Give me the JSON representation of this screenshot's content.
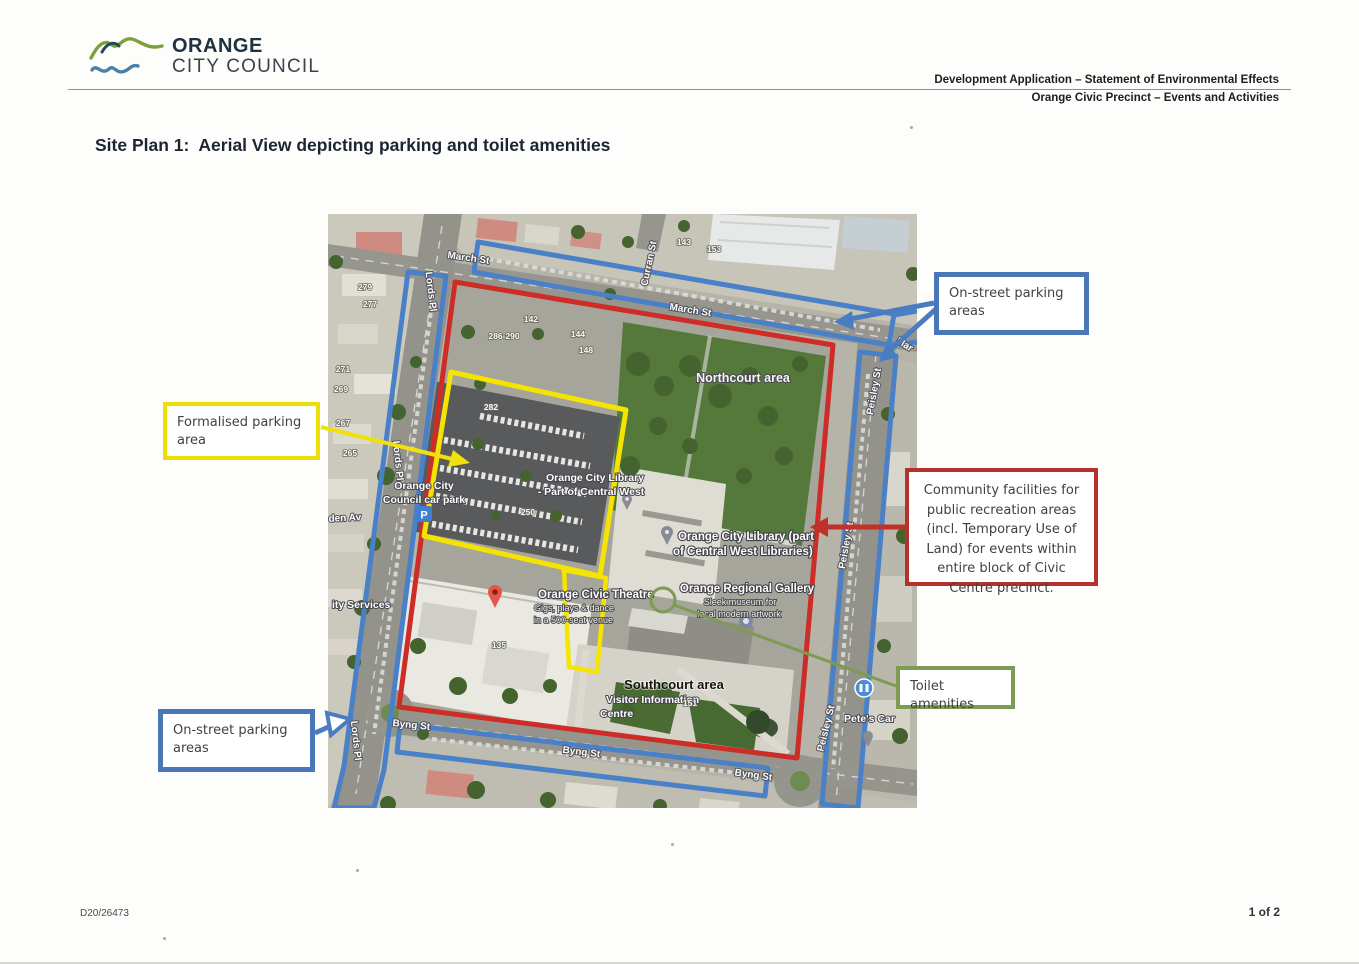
{
  "logo": {
    "name": "ORANGE",
    "subname": "CITY COUNCIL"
  },
  "header": {
    "line1": "Development Application – Statement of Environmental Effects",
    "line2": "Orange Civic Precinct – Events and Activities"
  },
  "title": "Site Plan 1:  Aerial View depicting parking and toilet amenities",
  "footer": {
    "ref": "D20/26473",
    "page": "1 of 2"
  },
  "colors": {
    "callout_blue": "#4a77b8",
    "callout_yellow": "#eddf05",
    "callout_red": "#b5312d",
    "callout_green": "#7d9b53",
    "overlay_blue": "#4a80c8",
    "overlay_red": "#cd2d26",
    "overlay_yellow": "#f4e400",
    "overlay_green": "#7d9b53"
  },
  "callouts": {
    "onstreet_top": {
      "text": "On-street parking areas"
    },
    "formalised": {
      "text": "Formalised parking area"
    },
    "community": {
      "text": "Community facilities for public recreation areas (incl. Temporary Use of Land) for events within entire block of Civic Centre precinct."
    },
    "toilet": {
      "text": "Toilet amenities"
    },
    "onstreet_bottom": {
      "text": "On-street parking areas"
    }
  },
  "map": {
    "streets": {
      "march1": "March St",
      "march2": "March St",
      "curran": "Curran St",
      "lords_top": "Lords Pl",
      "lords_mid": "Lords Pl",
      "lords_bottom": "Lords Pl",
      "peisley1": "Peisley St",
      "peisley2": "Peisley St",
      "peisley3": "Peisley St",
      "byng0": "Byng St",
      "byng1": "Byng St",
      "byng2": "Byng St",
      "avenue": "den Av",
      "mar": "Mar"
    },
    "places": {
      "northcourt": "Northcourt area",
      "southcourt": "Southcourt area",
      "council_l1": "Orange City",
      "council_l2": "Council car park",
      "libsmall_l1": "Orange City Library",
      "libsmall_l2": "- Part of Central West",
      "library_l1": "Orange City Library (part",
      "library_l2": "of Central West Libraries)",
      "gallery_l1": "Orange Regional Gallery",
      "gallery_l2": "Sleek museum for",
      "gallery_l3": "local modern artwork",
      "theatre_l1": "Orange Civic Theatre",
      "theatre_l2": "Gigs, plays & dance",
      "theatre_l3": "in a 500-seat venue",
      "visitor_l1": "Visitor Information",
      "visitor_l2": "Centre",
      "services": "ity Services",
      "petes": "Pete's Car"
    },
    "numbers": {
      "n279": "279",
      "n277": "277",
      "n271": "271",
      "n269": "269",
      "n267": "267",
      "n265": "265",
      "n286": "286-290",
      "n282": "282",
      "n142": "142",
      "n144": "144",
      "n148": "148",
      "n143": "143",
      "n153": "153",
      "n250": "250",
      "n151": "151",
      "n135": "135"
    },
    "icons": {
      "parking_glyph": "P"
    }
  }
}
